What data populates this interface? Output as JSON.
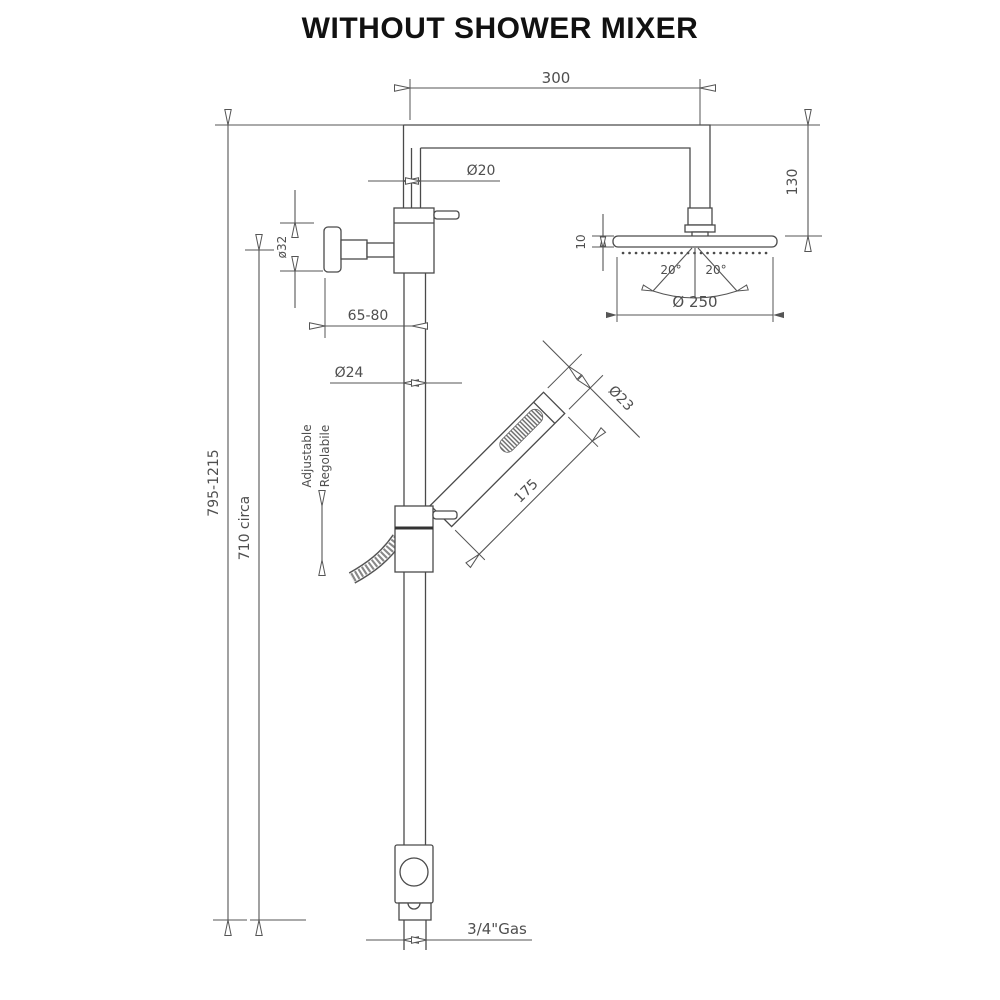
{
  "title": "WITHOUT SHOWER MIXER",
  "labels": {
    "arm_length": "300",
    "riser_diameter": "Ø20",
    "head_drop": "130",
    "head_thickness": "10",
    "spray_angle_left": "20°",
    "spray_angle_right": "20°",
    "head_diameter": "Ø 250",
    "bracket_diameter": "ø32",
    "wall_distance": "65-80",
    "rail_diameter": "Ø24",
    "handset_diameter": "Ø23",
    "handset_length": "175",
    "adjustable_en": "Adjustable",
    "adjustable_it": "Regolabile",
    "total_height": "795-1215",
    "rail_height": "710 circa",
    "connection": "3/4\"Gas"
  },
  "colors": {
    "line": "#4a4a4a",
    "text": "#4f4f4f",
    "title": "#111111",
    "background": "#ffffff"
  }
}
